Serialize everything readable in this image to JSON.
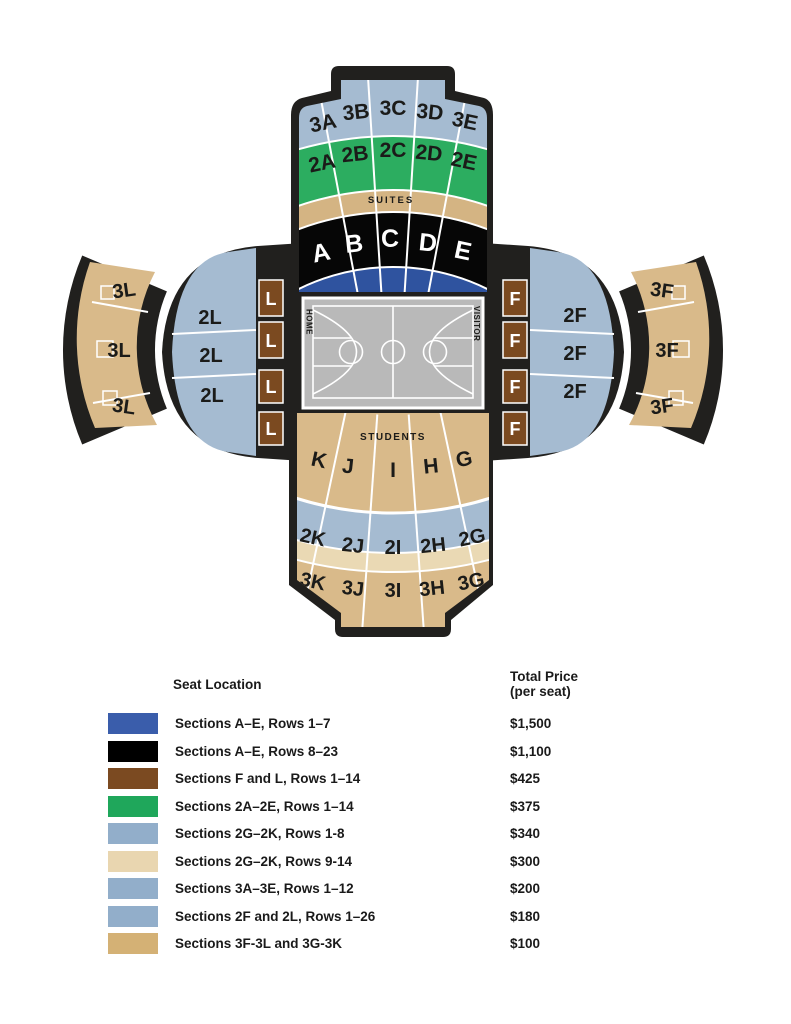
{
  "map": {
    "colors": {
      "outline_black": "#21201E",
      "blue_gray_sections": "#A5BBD1",
      "green_sections": "#2CAD60",
      "tan_sections": "#D9BA8A",
      "suites_band_tan": "#D4B483",
      "light_tan_band": "#EAD9B4",
      "courtside_black": "#060606",
      "courtside_blue": "#2F539F",
      "brown_sections": "#7B4A20",
      "court_gray": "#B9B9B9"
    },
    "top_wing": {
      "tier3": [
        "3A",
        "3B",
        "3C",
        "3D",
        "3E"
      ],
      "tier2": [
        "2A",
        "2B",
        "2C",
        "2D",
        "2E"
      ],
      "suites_label": "SUITES",
      "tier1": [
        "A",
        "B",
        "C",
        "D",
        "E"
      ]
    },
    "left_wing": {
      "outer": [
        "3L",
        "3L",
        "3L"
      ],
      "mid": [
        "2L",
        "2L",
        "2L"
      ],
      "inner": [
        "L",
        "L",
        "L",
        "L"
      ]
    },
    "right_wing": {
      "outer": [
        "3F",
        "3F",
        "3F"
      ],
      "mid": [
        "2F",
        "2F",
        "2F"
      ],
      "inner": [
        "F",
        "F",
        "F",
        "F"
      ]
    },
    "bottom_wing": {
      "students_label": "STUDENTS",
      "tier1": [
        "K",
        "J",
        "I",
        "H",
        "G"
      ],
      "tier2": [
        "2K",
        "2J",
        "2I",
        "2H",
        "2G"
      ],
      "tier3": [
        "3K",
        "3J",
        "3I",
        "3H",
        "3G"
      ]
    },
    "court": {
      "home_label": "HOME",
      "visitor_label": "VISITOR"
    }
  },
  "legend": {
    "seat_location_header": "Seat Location",
    "price_header_line1": "Total Price",
    "price_header_line2": "(per seat)",
    "rows": [
      {
        "color": "#3A5DAB",
        "label": "Sections A–E, Rows 1–7",
        "price": "$1,500"
      },
      {
        "color": "#000000",
        "label": "Sections A–E, Rows 8–23",
        "price": "$1,100"
      },
      {
        "color": "#7B4A21",
        "label": "Sections F and L, Rows 1–14",
        "price": "$425"
      },
      {
        "color": "#1FA75B",
        "label": "Sections 2A–2E, Rows 1–14",
        "price": "$375"
      },
      {
        "color": "#92AECA",
        "label": "Sections 2G–2K, Rows 1-8",
        "price": "$340"
      },
      {
        "color": "#E9D6B0",
        "label": "Sections 2G–2K, Rows 9-14",
        "price": "$300"
      },
      {
        "color": "#92AECA",
        "label": "Sections 3A–3E, Rows 1–12",
        "price": "$200"
      },
      {
        "color": "#92AECA",
        "label": "Sections 2F and 2L, Rows 1–26",
        "price": "$180"
      },
      {
        "color": "#D4B175",
        "label": "Sections 3F-3L and 3G-3K",
        "price": "$100"
      }
    ]
  }
}
